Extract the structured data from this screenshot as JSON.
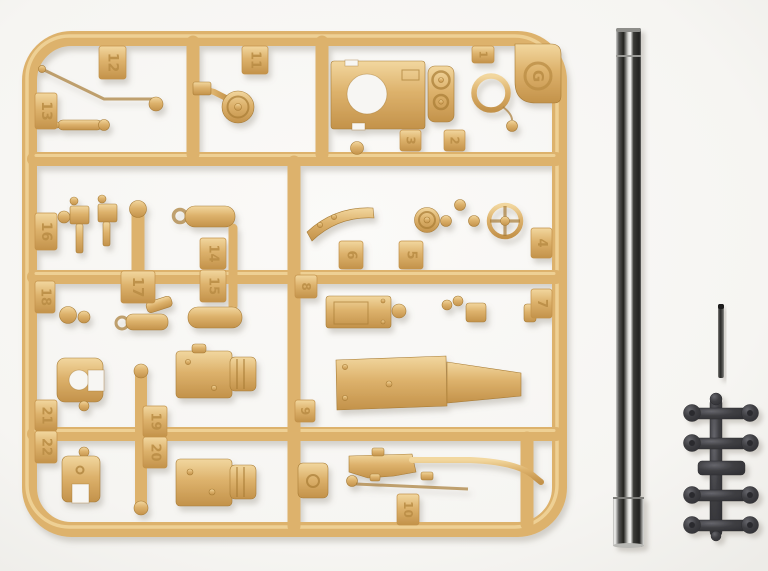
{
  "colors": {
    "bg": "#f7f6f3",
    "tan": "#ddb26c",
    "tan_light": "#f2d79f",
    "tan_dark": "#c3924a",
    "tan_deep": "#a87c35",
    "tan_emboss": "#b98c44",
    "metal_light": "#f4f4f2",
    "metal_mid": "#b9b9b6",
    "metal_dark": "#222220",
    "dark_part": "#3f3f43",
    "dark_part_light": "#66666c"
  },
  "sprue": {
    "letter_mark": "G",
    "part_tags": [
      {
        "label": "1"
      },
      {
        "label": "2"
      },
      {
        "label": "3"
      },
      {
        "label": "4"
      },
      {
        "label": "5"
      },
      {
        "label": "6"
      },
      {
        "label": "7"
      },
      {
        "label": "8"
      },
      {
        "label": "9"
      },
      {
        "label": "10"
      },
      {
        "label": "11"
      },
      {
        "label": "12"
      },
      {
        "label": "13"
      },
      {
        "label": "14"
      },
      {
        "label": "15"
      },
      {
        "label": "16"
      },
      {
        "label": "17"
      },
      {
        "label": "18"
      },
      {
        "label": "19"
      },
      {
        "label": "20"
      },
      {
        "label": "21"
      },
      {
        "label": "22"
      }
    ]
  }
}
